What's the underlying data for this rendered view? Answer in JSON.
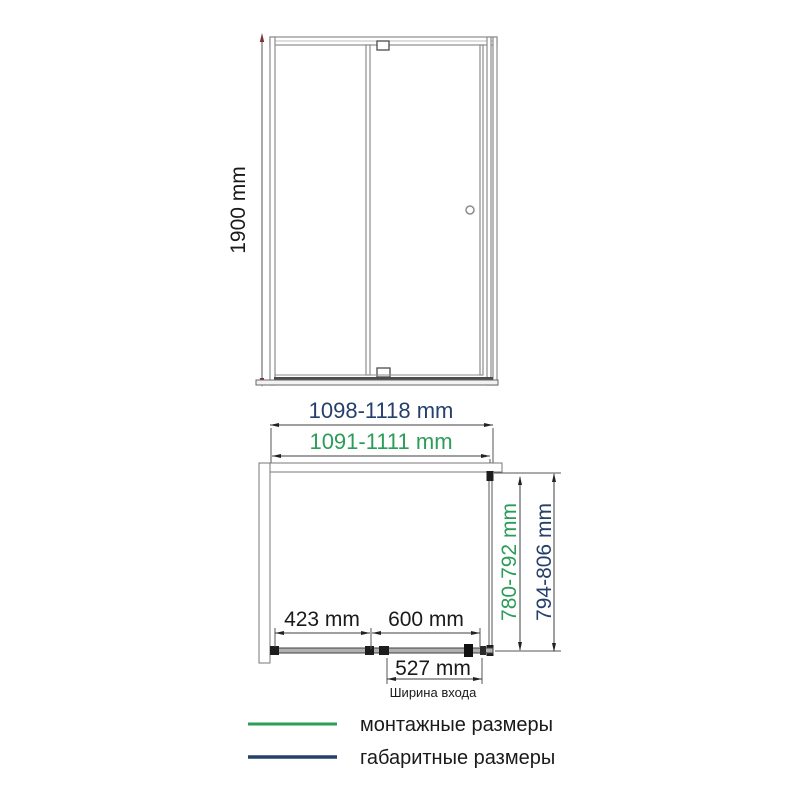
{
  "drawing": {
    "front_view": {
      "height_label": "1900 mm"
    },
    "plan_view": {
      "overall_width_label": "1098-1118 mm",
      "mounting_width_label": "1091-1111 mm",
      "fixed_panel_label": "423 mm",
      "door_panel_label": "600 mm",
      "entry_width_label": "527 mm",
      "entry_caption": "Ширина входа",
      "mounting_depth_label": "780-792 mm",
      "overall_depth_label": "794-806 mm"
    },
    "legend": {
      "mounting_label": "монтажные размеры",
      "overall_label": "габаритные размеры"
    }
  },
  "colors": {
    "green": "#2b9d58",
    "navy": "#24406b",
    "text_black": "#1a1a1a",
    "dim_line": "#3f3f3f",
    "red_arrow": "#7b3434",
    "frame": "#8c8c8c",
    "frame_dark": "#4c4c4c",
    "track_fill": "#b0b0b0",
    "hardware_black": "#1d1d1d"
  }
}
